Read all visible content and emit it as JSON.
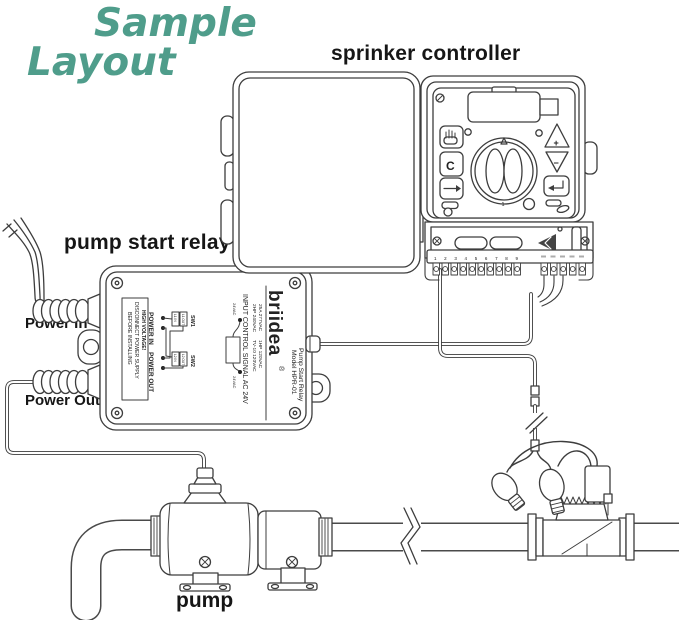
{
  "title": {
    "word1": "Sample",
    "word2": "Layout",
    "color": "#4f9d8b"
  },
  "labels": {
    "controller": "sprinker controller",
    "relay": "pump start relay",
    "power_in": "Power In",
    "power_out": "Power Out",
    "pump": "pump"
  },
  "relay_label": {
    "brand": "briidea",
    "reg": "®",
    "model_line1": "Pump Start Relay",
    "model_line2": "Model HPR-01",
    "spec1": "25A 277VAC",
    "spec2": "2HP 240VAC",
    "spec3": "1HP 120VAC",
    "spec4": "TV-10 120VAC",
    "input_signal": "INPUT CONTROL SIGNAL AC 24V",
    "power_in": "POWER IN",
    "power_out": "POWER OUT",
    "sw1": "SW1",
    "sw2": "SW2",
    "sw1_in": "L1 IN",
    "sw1_out": "L1 OUT",
    "sw2_in": "L2 IN",
    "sw2_out": "L2 OUT",
    "coil_top": "24VAC",
    "coil_bottom": "24VAC",
    "warn1": "HIGH  VOLTAGE!",
    "warn2": "DISCONNECT POWER SUPPLY",
    "warn3": "BEFORE INSTALLING"
  },
  "controller": {
    "btn_c": "C",
    "btn_plus": "+",
    "btn_minus": "−",
    "dial_pos": "1",
    "terminals": "1 2 3 4 5 6 7 8 9"
  }
}
